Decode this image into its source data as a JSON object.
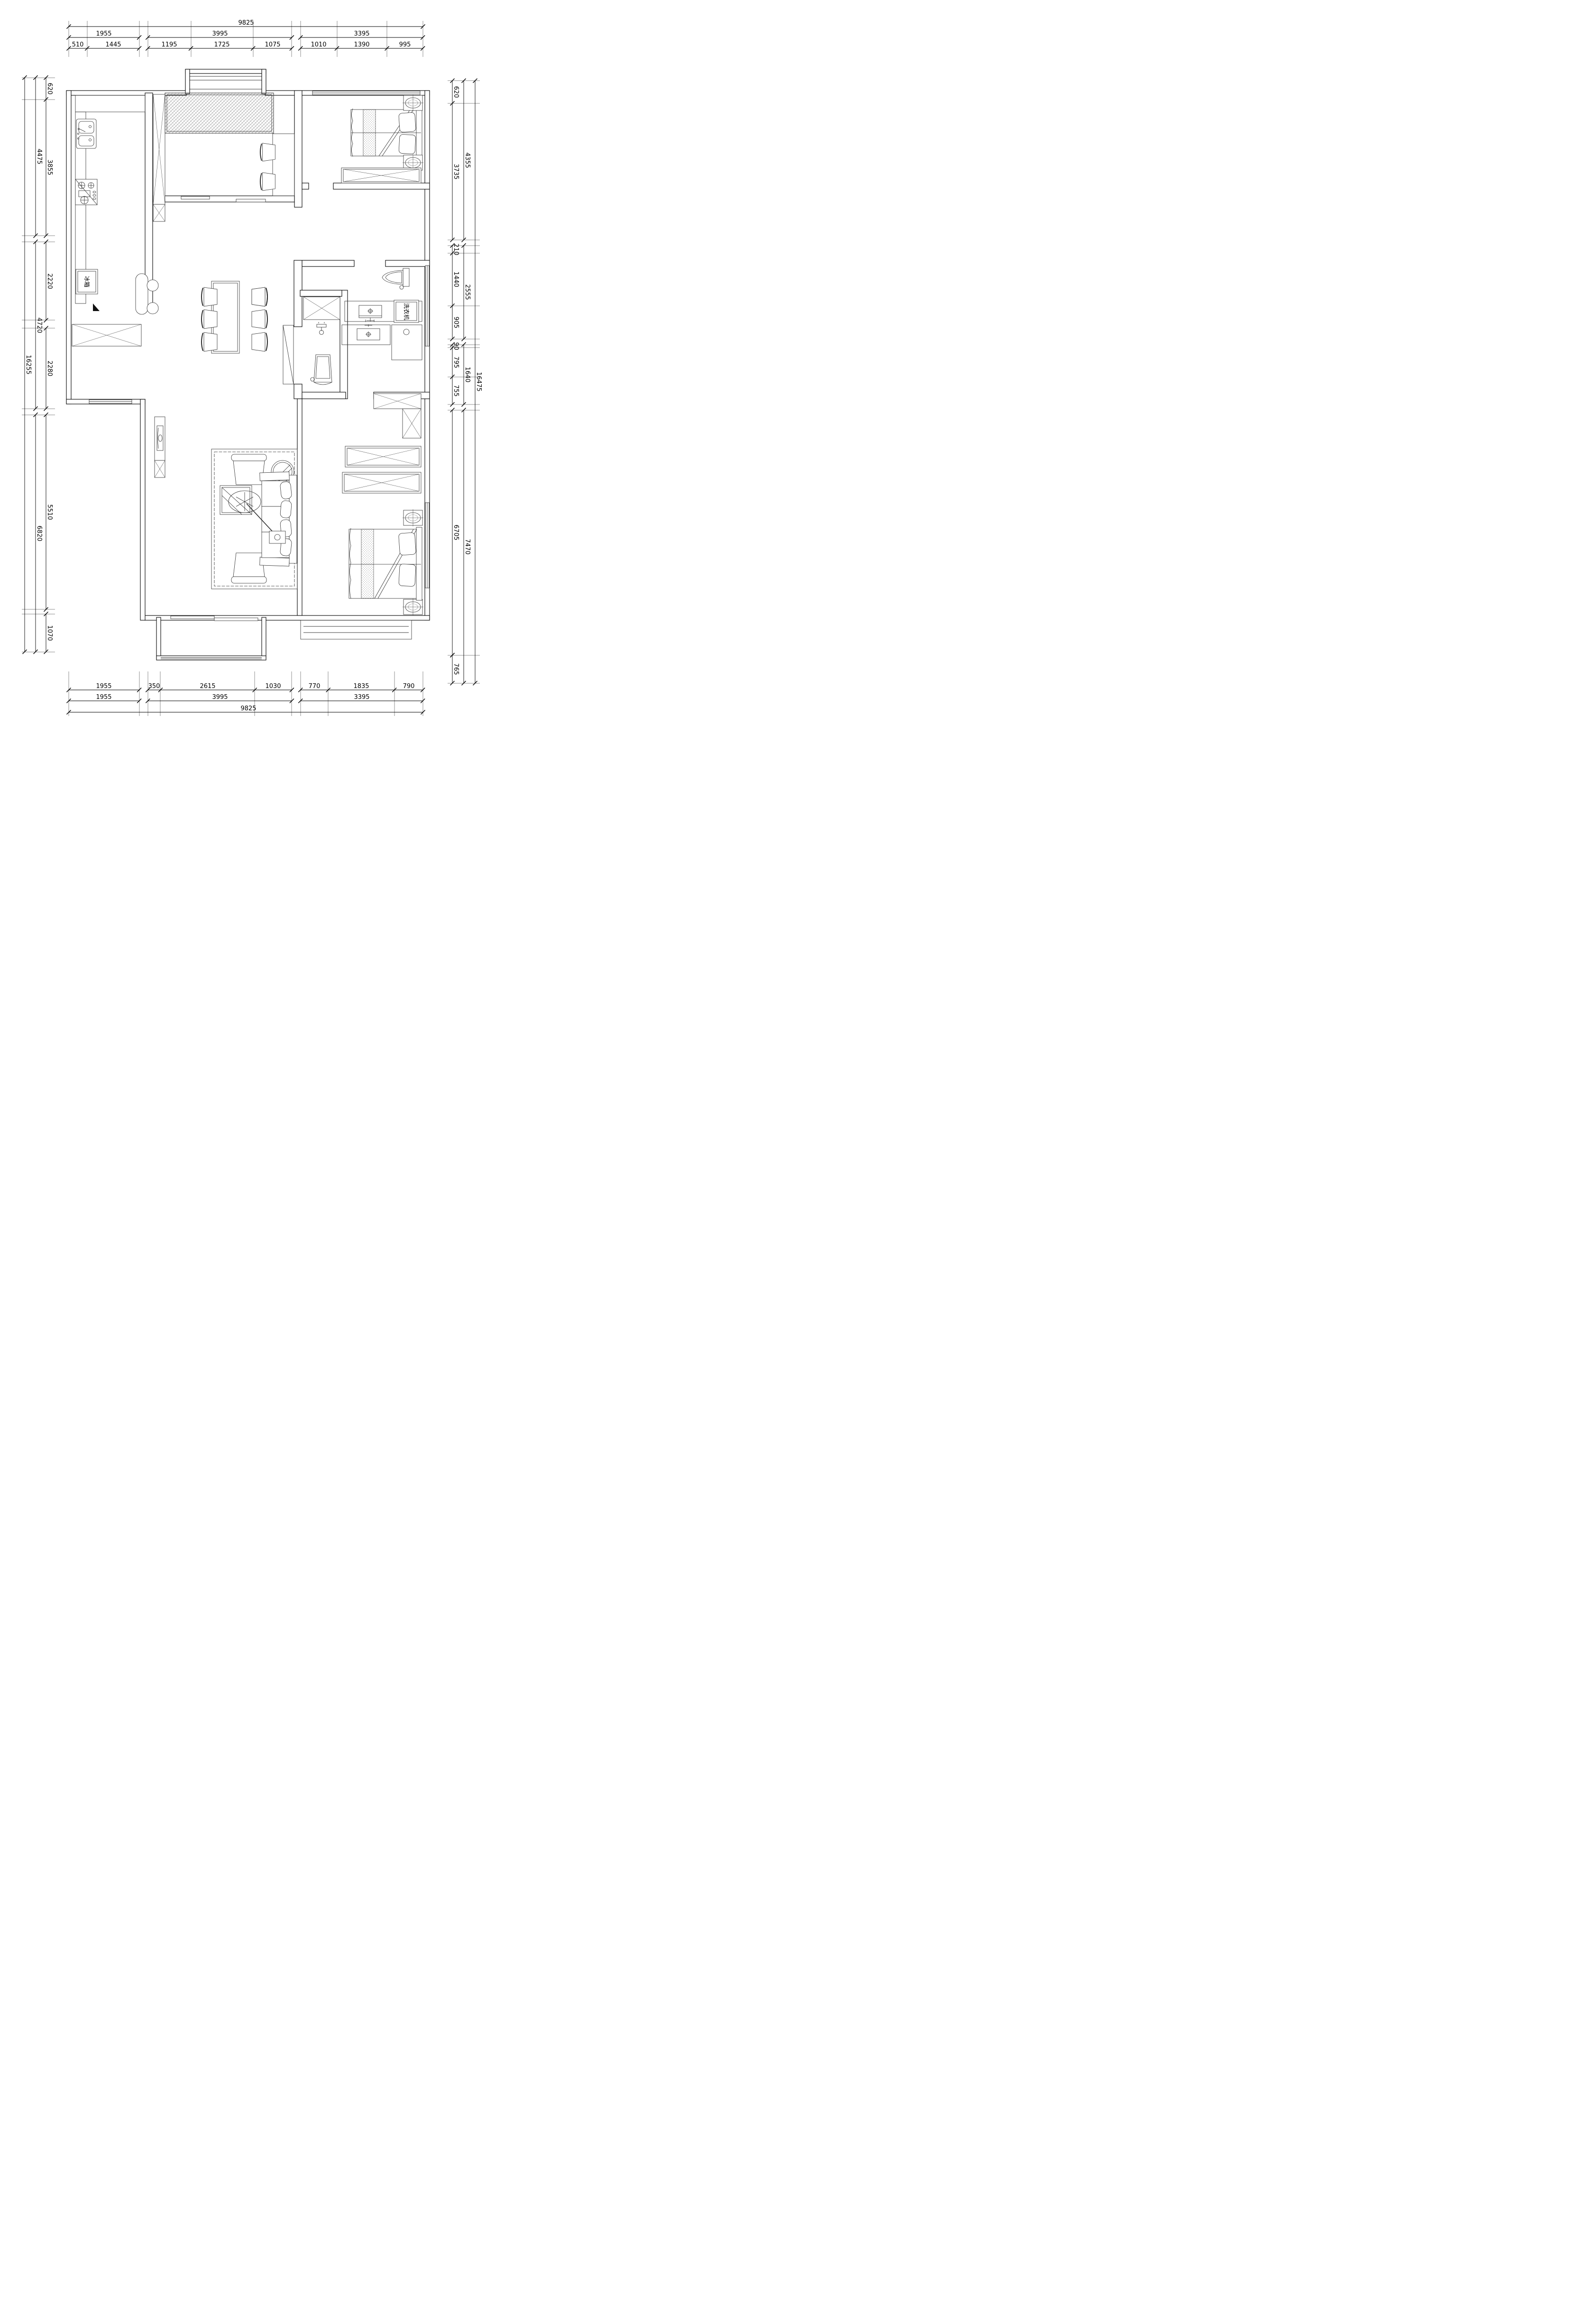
{
  "labels": {
    "fridge": "冰箱",
    "washer": "洗衣机"
  },
  "style": {
    "line_color": "#000000",
    "dim_font_px": 13
  },
  "dim_groups": [
    {
      "id": "top",
      "orient": "h",
      "ext": [
        44,
        120
      ],
      "chains": [
        {
          "pos": 56,
          "segments": [
            {
              "ticks": [
                145,
                892
              ],
              "labels": [
                {
                  "t": "9825",
                  "p": 519
                }
              ]
            }
          ]
        },
        {
          "pos": 79,
          "segments": [
            {
              "ticks": [
                145,
                293.6
              ],
              "labels": [
                {
                  "t": "1955",
                  "p": 219
                }
              ]
            },
            {
              "ticks": [
                311.8,
                615.4
              ],
              "labels": [
                {
                  "t": "3995",
                  "p": 464
                }
              ]
            },
            {
              "ticks": [
                633.7,
                891.7
              ],
              "labels": [
                {
                  "t": "3395",
                  "p": 763
                }
              ]
            }
          ]
        },
        {
          "pos": 102,
          "segments": [
            {
              "ticks": [
                145,
                183.8,
                293.6
              ],
              "labels": [
                {
                  "t": "510",
                  "p": 164
                },
                {
                  "t": "1445",
                  "p": 239
                }
              ]
            },
            {
              "ticks": [
                311.8,
                402.6,
                533.7,
                615.4
              ],
              "labels": [
                {
                  "t": "1195",
                  "p": 357
                },
                {
                  "t": "1725",
                  "p": 468
                },
                {
                  "t": "1075",
                  "p": 575
                }
              ]
            },
            {
              "ticks": [
                633.7,
                710.5,
                816.1,
                891.7
              ],
              "labels": [
                {
                  "t": "1010",
                  "p": 672
                },
                {
                  "t": "1390",
                  "p": 763
                },
                {
                  "t": "995",
                  "p": 854
                }
              ]
            }
          ]
        }
      ]
    },
    {
      "id": "bottom",
      "orient": "h",
      "ext": [
        1416,
        1510
      ],
      "chains": [
        {
          "pos": 1455,
          "segments": [
            {
              "ticks": [
                145,
                293.6
              ],
              "labels": [
                {
                  "t": "1955",
                  "p": 219
                }
              ]
            },
            {
              "ticks": [
                311.8,
                338.4,
                537.2,
                615.4
              ],
              "labels": [
                {
                  "t": "350",
                  "p": 325
                },
                {
                  "t": "2615",
                  "p": 438
                },
                {
                  "t": "1030",
                  "p": 576
                }
              ]
            },
            {
              "ticks": [
                633.7,
                692.2,
                831.7,
                891.7
              ],
              "labels": [
                {
                  "t": "770",
                  "p": 663
                },
                {
                  "t": "1835",
                  "p": 762
                },
                {
                  "t": "790",
                  "p": 862
                }
              ]
            }
          ]
        },
        {
          "pos": 1478,
          "segments": [
            {
              "ticks": [
                145,
                293.6
              ],
              "labels": [
                {
                  "t": "1955",
                  "p": 219
                }
              ]
            },
            {
              "ticks": [
                311.8,
                615.4
              ],
              "labels": [
                {
                  "t": "3995",
                  "p": 464
                }
              ]
            },
            {
              "ticks": [
                633.7,
                891.7
              ],
              "labels": [
                {
                  "t": "3395",
                  "p": 763
                }
              ]
            }
          ]
        },
        {
          "pos": 1502,
          "segments": [
            {
              "ticks": [
                145,
                892
              ],
              "labels": [
                {
                  "t": "9825",
                  "p": 524
                }
              ]
            }
          ]
        }
      ]
    },
    {
      "id": "left",
      "orient": "v",
      "ext": [
        46,
        116
      ],
      "chains": [
        {
          "pos": 52,
          "segments": [
            {
              "ticks": [
                163.6,
                1374.5
              ],
              "labels": [
                {
                  "t": "16255",
                  "p": 769
                }
              ]
            }
          ]
        },
        {
          "pos": 75,
          "segments": [
            {
              "ticks": [
                163.6,
                497
              ],
              "labels": [
                {
                  "t": "4475",
                  "p": 330
                }
              ]
            },
            {
              "ticks": [
                510,
                861.8
              ],
              "labels": [
                {
                  "t": "4720",
                  "p": 686
                }
              ]
            },
            {
              "ticks": [
                874.8,
                1374.5
              ],
              "labels": [
                {
                  "t": "6820",
                  "p": 1125
                }
              ]
            }
          ]
        },
        {
          "pos": 97,
          "segments": [
            {
              "ticks": [
                163.6,
                209.8,
                497
              ],
              "labels": [
                {
                  "t": "620",
                  "p": 187
                },
                {
                  "t": "3855",
                  "p": 353
                }
              ]
            },
            {
              "ticks": [
                510,
                675.4
              ],
              "labels": [
                {
                  "t": "2220",
                  "p": 593
                }
              ]
            },
            {
              "ticks": [
                692.1,
                861.8
              ],
              "labels": [
                {
                  "t": "2280",
                  "p": 777
                }
              ]
            },
            {
              "ticks": [
                874.8,
                1285.3
              ],
              "labels": [
                {
                  "t": "5510",
                  "p": 1080
                }
              ]
            },
            {
              "ticks": [
                1294.8,
                1374.5
              ],
              "labels": [
                {
                  "t": "1070",
                  "p": 1335
                }
              ]
            }
          ]
        }
      ]
    },
    {
      "id": "right",
      "orient": "v",
      "ext": [
        944,
        1012
      ],
      "chains": [
        {
          "pos": 1002,
          "segments": [
            {
              "ticks": [
                170.1,
                1440.6
              ],
              "labels": [
                {
                  "t": "16475",
                  "p": 805
                }
              ]
            }
          ]
        },
        {
          "pos": 978,
          "segments": [
            {
              "ticks": [
                170.1,
                505.9
              ],
              "labels": [
                {
                  "t": "4355",
                  "p": 338
                }
              ]
            },
            {
              "ticks": [
                517.7,
                714.7
              ],
              "labels": [
                {
                  "t": "2555",
                  "p": 616
                }
              ]
            },
            {
              "ticks": [
                726.5,
                852.9
              ],
              "labels": [
                {
                  "t": "1640",
                  "p": 790
                }
              ]
            },
            {
              "ticks": [
                864.7,
                1440.6
              ],
              "labels": [
                {
                  "t": "7470",
                  "p": 1153
                }
              ]
            }
          ]
        },
        {
          "pos": 954,
          "segments": [
            {
              "ticks": [
                170.1,
                217.9,
                505.9
              ],
              "labels": [
                {
                  "t": "620",
                  "p": 194
                },
                {
                  "t": "3735",
                  "p": 362
                }
              ]
            },
            {
              "ticks": [
                517.7,
                533.9,
                644.9,
                714.7
              ],
              "labels": [
                {
                  "t": "210",
                  "p": 526
                },
                {
                  "t": "1440",
                  "p": 589
                },
                {
                  "t": "905",
                  "p": 680
                }
              ]
            },
            {
              "ticks": [
                726.5,
                733.4,
                794.7,
                852.9
              ],
              "labels": [
                {
                  "t": "90",
                  "p": 730
                },
                {
                  "t": "795",
                  "p": 764
                },
                {
                  "t": "755",
                  "p": 824
                }
              ]
            },
            {
              "ticks": [
                864.7,
                1381.6
              ],
              "labels": [
                {
                  "t": "6705",
                  "p": 1123
                }
              ]
            },
            {
              "ticks": [
                1381.6,
                1440.6
              ],
              "labels": [
                {
                  "t": "765",
                  "p": 1411
                }
              ]
            }
          ]
        }
      ]
    }
  ]
}
